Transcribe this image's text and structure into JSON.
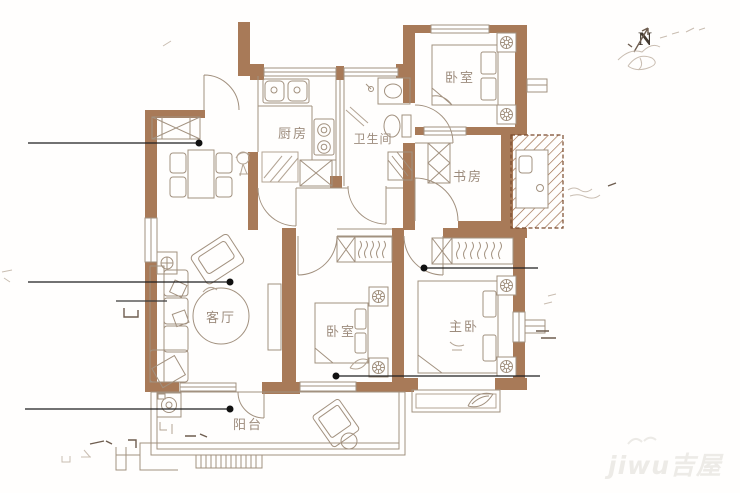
{
  "document": {
    "type": "apartment-floor-plan",
    "background": "#ffffff"
  },
  "colors": {
    "wall": "#a87a58",
    "furniture_line": "#a2917f",
    "label_text": "#9d8c7d",
    "leader_line": "#1f1f1f",
    "hatch": "#8a5636",
    "annotation": "#c9bdb1",
    "watermark": "#edebe7"
  },
  "rooms": {
    "kitchen": {
      "label": "厨房"
    },
    "bathroom": {
      "label": "卫生间"
    },
    "bedroom_top": {
      "label": "卧室"
    },
    "study": {
      "label": "书房"
    },
    "living_room": {
      "label": "客厅"
    },
    "bedroom_second": {
      "label": "卧室"
    },
    "master_bedroom": {
      "label": "主卧"
    },
    "balcony": {
      "label": "阳台"
    }
  },
  "compass": {
    "north_label": "N"
  },
  "watermark": {
    "text": "jiwu吉屋"
  }
}
